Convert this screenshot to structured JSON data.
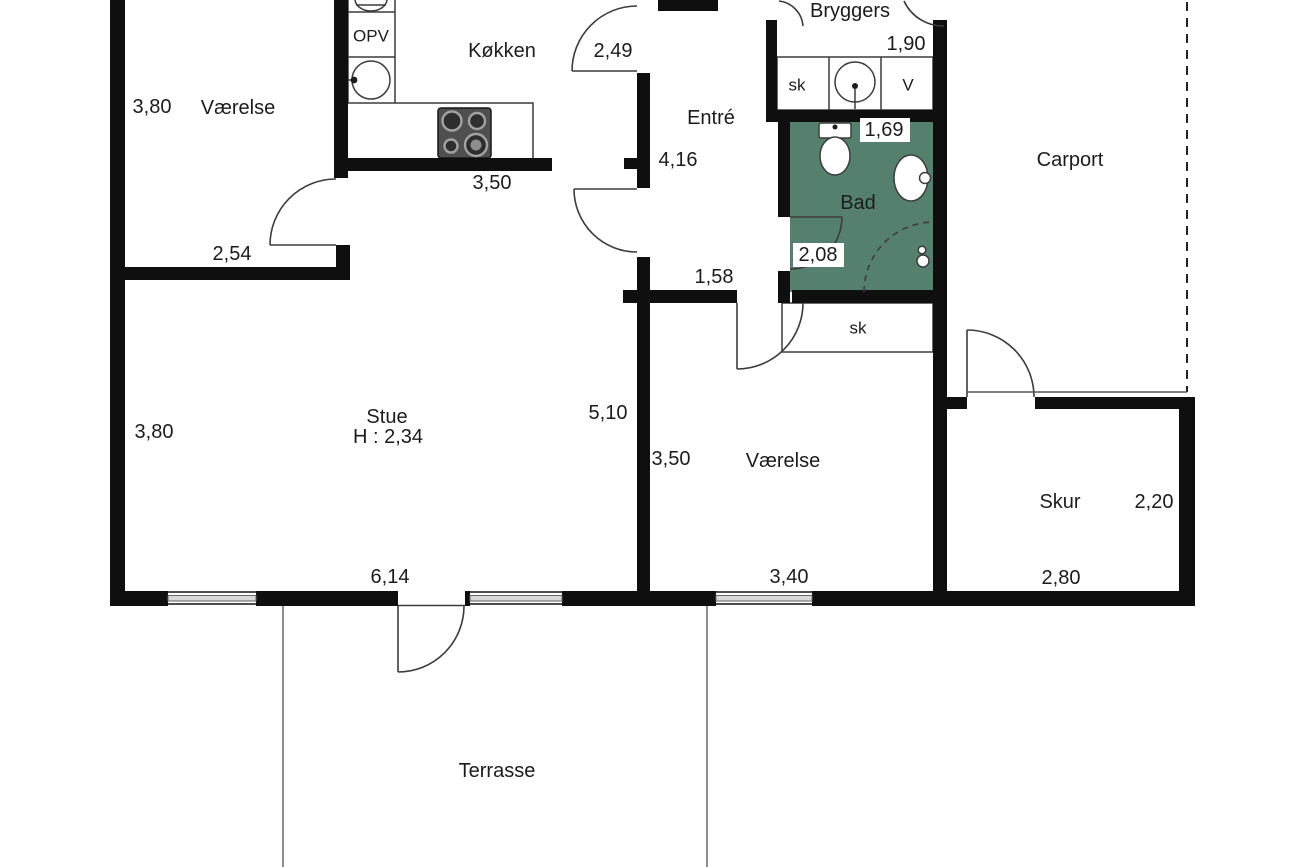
{
  "title": "Floor plan (Danish house plan)",
  "colors": {
    "wall": "#0f0f0f",
    "bad_floor": "#56806E",
    "line": "#3c3c3c",
    "window": "#d8d8d8",
    "cooktop": "#4f4f4f",
    "text": "#1c1c1c",
    "background": "#ffffff"
  },
  "labels": {
    "room_nw_dim": "3,80",
    "room_nw": "Værelse",
    "kitchen": "Køkken",
    "kitchen_door_dim": "2,49",
    "opv": "OPV",
    "kitchen_wall_dim": "3,50",
    "room_nw_width_dim": "2,54",
    "entre": "Entré",
    "entre_dim": "4,16",
    "bryggers": "Bryggers",
    "bryggers_dim": "1,90",
    "bryggers_sk": "sk",
    "bryggers_v": "V",
    "bad": "Bad",
    "bad_width_dim": "1,69",
    "bad_door_dim": "2,08",
    "hall_dim": "1,58",
    "closet_sk": "sk",
    "carport": "Carport",
    "stue": "Stue",
    "stue_height": "H : 2,34",
    "stue_west_dim": "3,80",
    "stue_east_dim": "5,10",
    "stue_south_dim": "6,14",
    "room_s_dim": "3,50",
    "room_s": "Værelse",
    "room_s_south_dim": "3,40",
    "skur": "Skur",
    "skur_width_dim": "2,20",
    "skur_south_dim": "2,80",
    "terrasse": "Terrasse"
  },
  "rooms": [
    {
      "name": "Værelse (NW)",
      "width_m": "2,54",
      "depth_m": "3,80"
    },
    {
      "name": "Køkken",
      "wall_m": "3,50",
      "door_m": "2,49"
    },
    {
      "name": "Entré",
      "length_m": "4,16",
      "passage_m": "1,58"
    },
    {
      "name": "Bryggers",
      "width_m": "1,90"
    },
    {
      "name": "Bad",
      "width_m": "1,69",
      "door_m": "2,08"
    },
    {
      "name": "Stue",
      "ceiling_h_m": "H : 2,34",
      "west_m": "3,80",
      "east_m": "5,10",
      "south_m": "6,14"
    },
    {
      "name": "Værelse (S)",
      "east_m": "3,50",
      "south_m": "3,40"
    },
    {
      "name": "Skur",
      "width_m": "2,80",
      "depth_m": "2,20"
    },
    {
      "name": "Carport"
    },
    {
      "name": "Terrasse"
    }
  ]
}
